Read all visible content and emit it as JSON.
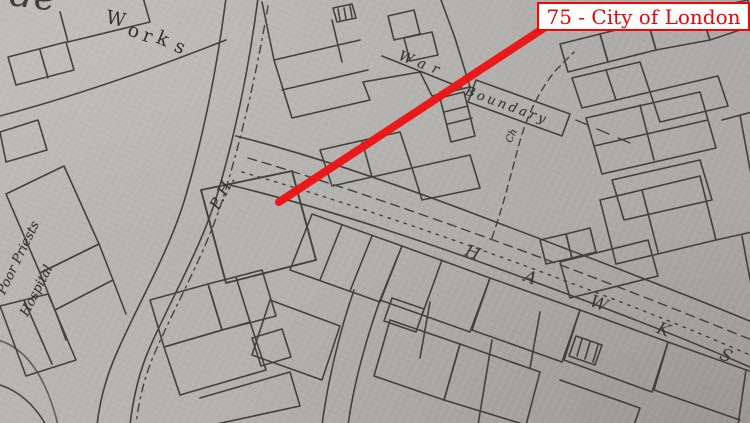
{
  "annotation": {
    "label_text": "75 - City of London",
    "text_color": "#e30613",
    "border_color": "#ff0000",
    "box_bg": "#fdfdfc",
    "line_color": "#ee1414"
  },
  "map": {
    "paper_color": "#b3b1ae",
    "ink_color": "#38362f",
    "labels": {
      "works_fragment": "de",
      "works_letters": [
        "W",
        "o",
        "r",
        "k",
        "s"
      ],
      "ward_word": "War",
      "boundary_word": "Boundary",
      "ph": "P.H.",
      "hospital_line1": "Poor Priests",
      "hospital_line2": "Hospital",
      "street_letters": [
        "H",
        "A",
        "W",
        "K",
        "S"
      ],
      "ch_mark": "Ch"
    }
  }
}
